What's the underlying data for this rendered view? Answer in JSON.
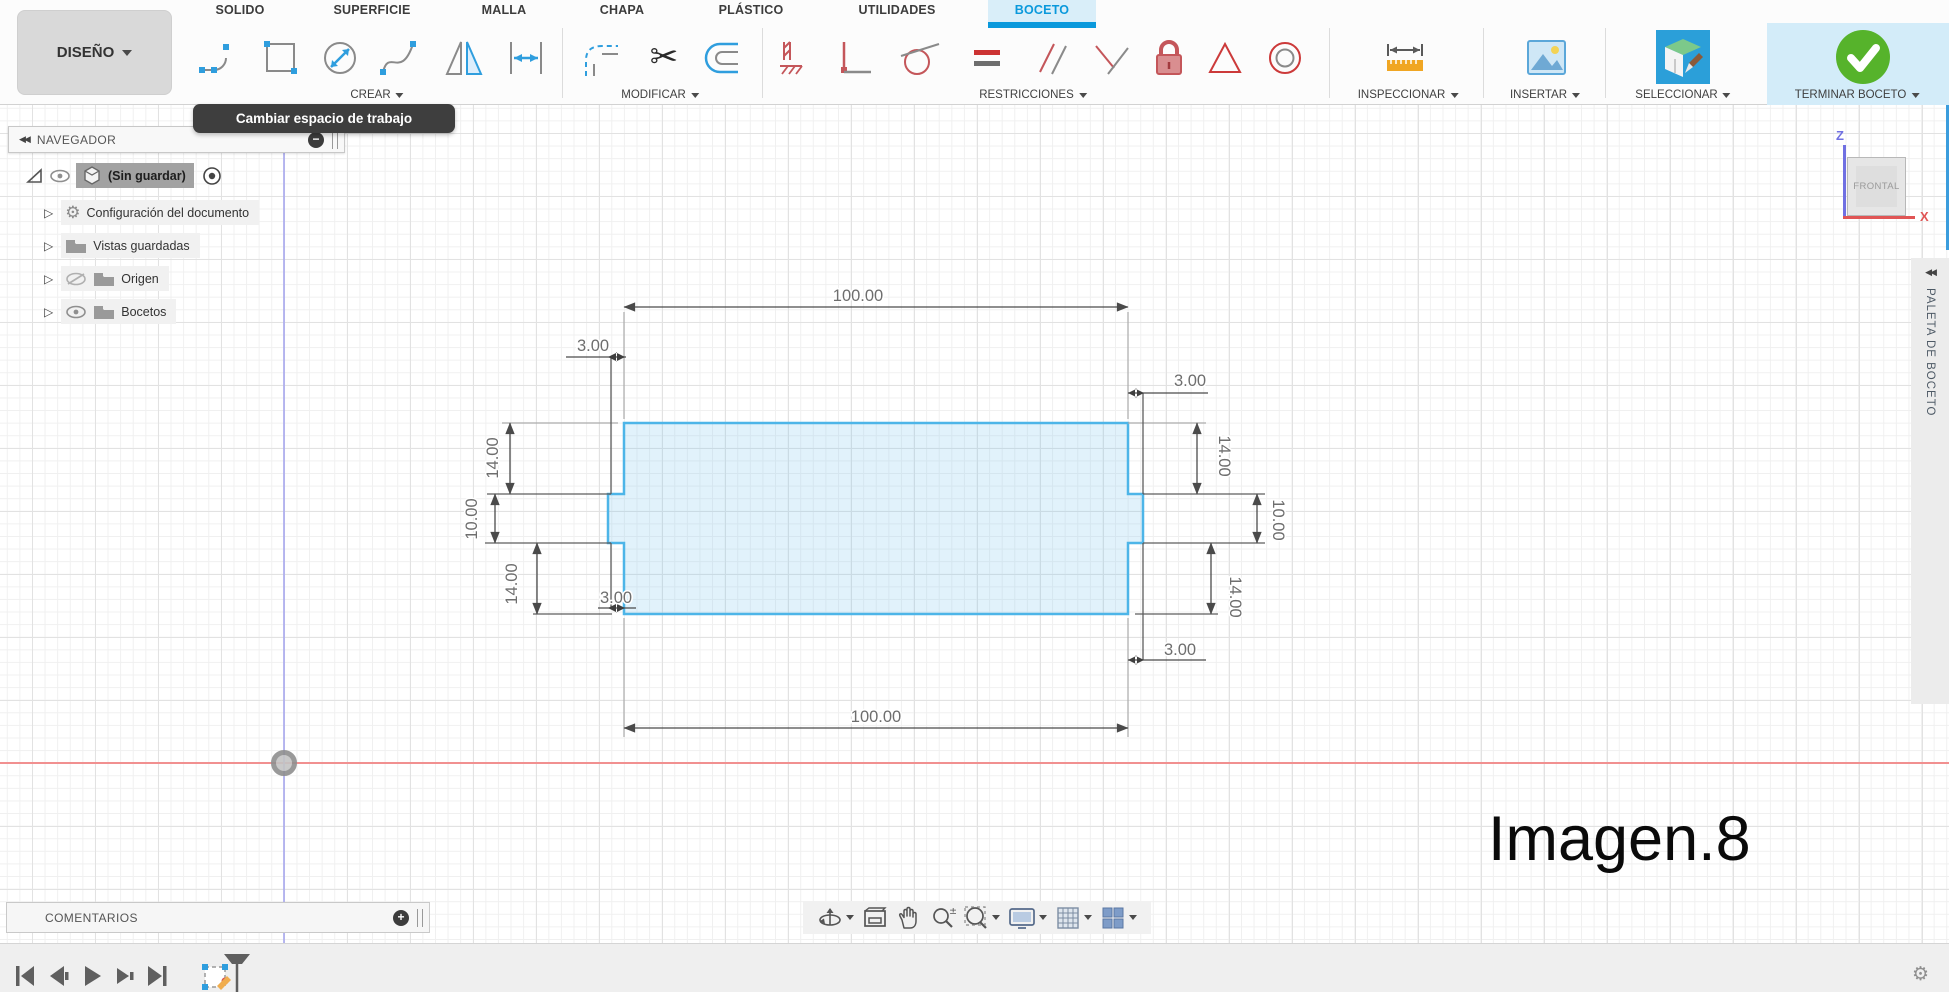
{
  "workspace_switcher": {
    "label": "DISEÑO"
  },
  "tabs": {
    "items": [
      {
        "label": "SOLIDO"
      },
      {
        "label": "SUPERFICIE"
      },
      {
        "label": "MALLA"
      },
      {
        "label": "CHAPA"
      },
      {
        "label": "PLÁSTICO"
      },
      {
        "label": "UTILIDADES"
      },
      {
        "label": "BOCETO"
      }
    ],
    "active": "BOCETO"
  },
  "groups": {
    "crear": "CREAR",
    "modificar": "MODIFICAR",
    "restricciones": "RESTRICCIONES",
    "inspeccionar": "INSPECCIONAR",
    "insertar": "INSERTAR",
    "seleccionar": "SELECCIONAR",
    "terminar_boceto": "TERMINAR BOCETO"
  },
  "tooltip": {
    "text": "Cambiar espacio de trabajo"
  },
  "navigator": {
    "title": "NAVEGADOR",
    "root": {
      "label": "(Sin guardar)"
    },
    "items": [
      {
        "label": "Configuración del documento"
      },
      {
        "label": "Vistas guardadas"
      },
      {
        "label": "Origen"
      },
      {
        "label": "Bocetos"
      }
    ]
  },
  "sketch_dims": {
    "width_top": "100.00",
    "width_bottom": "100.00",
    "offset_top_left": "3.00",
    "offset_top_right": "3.00",
    "offset_bottom_left": "3.00",
    "offset_bottom_right": "3.00",
    "height_upper_left": "14.00",
    "height_lower_left": "14.00",
    "height_upper_right": "14.00",
    "height_lower_right": "14.00",
    "notch_left": "10.00",
    "notch_right": "10.00"
  },
  "viewcube": {
    "face": "FRONTAL",
    "axis_z": "Z",
    "axis_x": "X"
  },
  "palette": {
    "title": "PALETA DE BOCETO"
  },
  "comments": {
    "title": "COMENTARIOS"
  },
  "caption": {
    "text": "Imagen.8"
  },
  "colors": {
    "accent_blue": "#0a99dc",
    "sketch_stroke": "#4db5e8",
    "axis_x": "#f19090",
    "axis_y": "#ababef",
    "constraint_red": "#c4565a",
    "finish_green": "#56b32b"
  }
}
